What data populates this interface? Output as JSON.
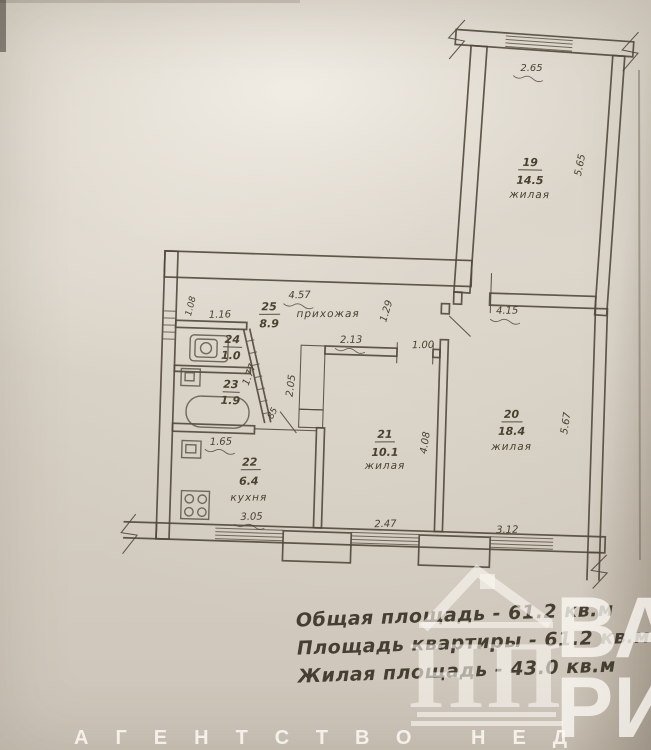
{
  "plan": {
    "rooms": {
      "r19": {
        "number": "19",
        "area": "14.5",
        "name": "жилая"
      },
      "r20": {
        "number": "20",
        "area": "18.4",
        "name": "жилая"
      },
      "r21": {
        "number": "21",
        "area": "10.1",
        "name": "жилая"
      },
      "r22": {
        "number": "22",
        "area": "6.4",
        "name": "кухня"
      },
      "r23": {
        "number": "23",
        "area": "1.9"
      },
      "r24": {
        "number": "24",
        "area": "1.0"
      },
      "r25": {
        "number": "25",
        "area": "8.9",
        "name": "прихожая"
      }
    },
    "dimensions": {
      "room19_window": "2.65",
      "room19_right": "5.65",
      "hall_top": "4.57",
      "wc_top": "1.16",
      "left_wall": "1.08",
      "bath_diag": "1.77",
      "bath_bottom": "1.65",
      "kitchen_window": "3.05",
      "corridor": "2.05",
      "corridor_pass": "85",
      "room21_top": "2.13",
      "room21_door": "1.00",
      "room21_right": "4.08",
      "room21_window": "2.47",
      "hall_pass": "1.29",
      "room20_top": "4.15",
      "room20_right": "5.67",
      "room20_window": "3.12"
    }
  },
  "summary": {
    "line1": "Общая площадь - 61.2 кв.м",
    "line2": "Площадь квартиры - 61.2 кв.м",
    "line3": "Жилая площадь - 43.0 кв.м"
  },
  "watermark": {
    "monogram": "НП",
    "big_line1": "ВА",
    "big_line2": "РИ",
    "agency": "АГЕНТСТВО НЕД"
  }
}
